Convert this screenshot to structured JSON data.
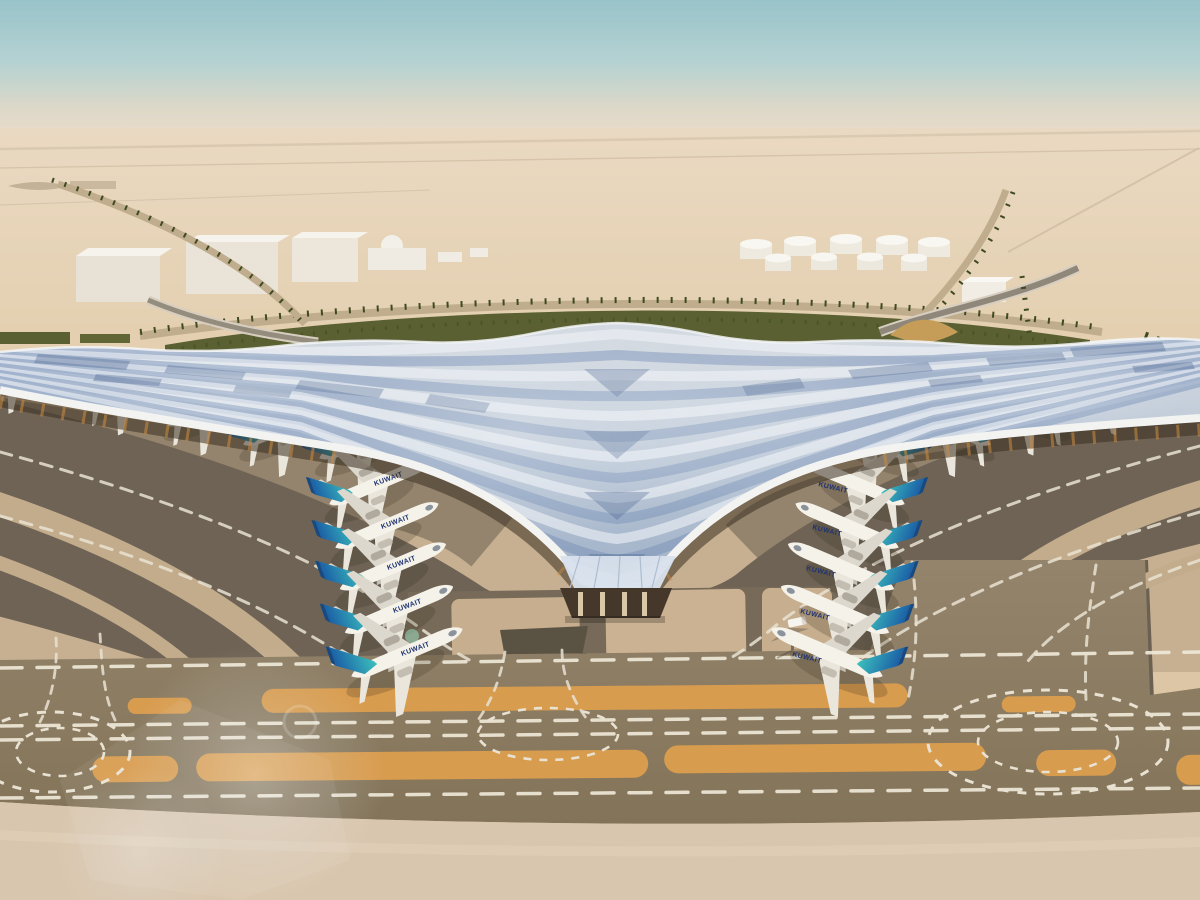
{
  "scene": {
    "type": "architectural-aerial-rendering",
    "subject": "desert airport terminal with V-shaped winged roof, parked airliners, taxiways and runway",
    "sky": {
      "top_color": "#98c3c9",
      "horizon_color": "#ecdccb"
    },
    "desert": {
      "far_color": "#ead9c2",
      "near_color": "#d8c1a0"
    },
    "landscape": {
      "green_strip": "#5a6032",
      "palm_dot": "#3f4a22",
      "road_tan": "#c0ad8e",
      "tank_white": "#efebe1",
      "building_white": "#f1ede4",
      "dune_gold": "#c59d58"
    },
    "terminal": {
      "roof_silver": "#d4dae1",
      "roof_blue": "#8fa7c6",
      "roof_edge_white": "#f3f4f1",
      "facade_shadow": "#3a2f21",
      "facade_glow": "#cd8c40",
      "canopy_glass": "#d8e2ec",
      "column_beige": "#d8c8a8"
    },
    "apron": {
      "light_concrete": "#c7b091",
      "mid_concrete": "#8e8069",
      "dark_lane": "#6e6355",
      "taxiway_band": "#8b7b64",
      "marking_orange": "#d89c4f",
      "marking_white": "#efe8d8",
      "bottom_strip": "#d9c6ae"
    },
    "aircraft": {
      "livery_text": "KUWAIT",
      "fuselage_color": "#f5f2ea",
      "tail_teal": "#3cc0bd",
      "tail_blue": "#1b5fa6",
      "count_visible": 22
    },
    "vehicles": {
      "service_van_color": "#f6f4ef"
    }
  }
}
